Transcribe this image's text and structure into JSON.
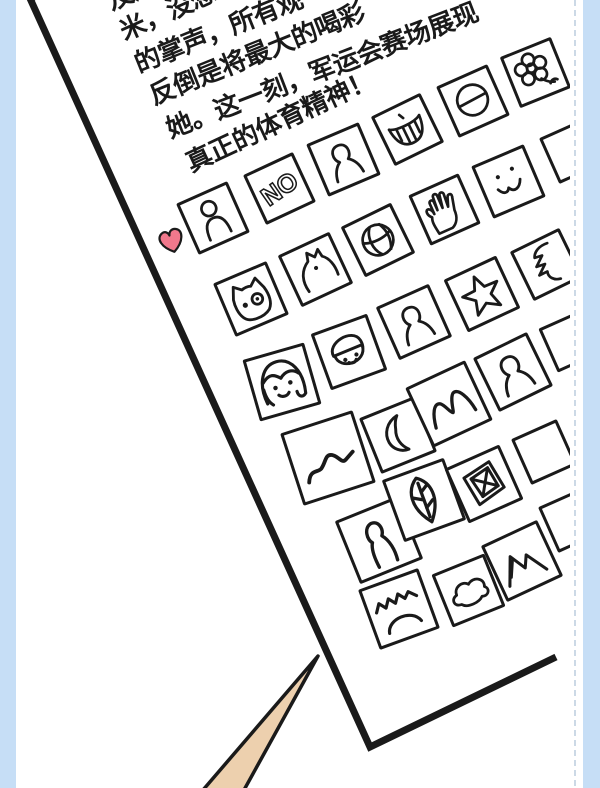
{
  "panel": {
    "type": "comic-webtoon-panel",
    "background_color": "#ffffff",
    "ink_color": "#1a1a1a"
  },
  "frame": {
    "side_strip_color": "#c6def6",
    "dashed_line_color": "#ccd9e6"
  },
  "page": {
    "description": "tilted white page with story text and a sheet of doodle stickers",
    "paragraph_lines": [
      "及远",
      "米，没想到",
      "的掌声，所有观",
      "反倒是将最大的喝彩",
      "她。这一刻，军运会赛场展现",
      "真正的体育精神！"
    ],
    "sticker_grid": {
      "no_label": "NO",
      "rows": [
        {
          "icons": [
            "person-outline",
            "no-text",
            "person-bust",
            "grin-teeth",
            "circle-slash",
            "flower"
          ]
        },
        {
          "icons": [
            "owl-face",
            "cat-profile",
            "basketball",
            "hand",
            "smiley-face",
            "clipped-box"
          ]
        },
        {
          "icons": [
            "girl-face",
            "boy-face",
            "person-bust",
            "star",
            "zigzag-profile"
          ]
        },
        {
          "icons": [
            "hills-line",
            "crescent-moon",
            "round-peaks",
            "person-bust",
            "clipped-box"
          ]
        },
        {
          "icons": [
            "person-tall",
            "leaf",
            "framed-note",
            "clipped-box"
          ]
        },
        {
          "icons": [
            "zigzag-waves-sun",
            "cloud",
            "mountains",
            "clipped-box"
          ]
        }
      ]
    },
    "heart_color": "#f1788c"
  },
  "pointer": {
    "description": "tan pointed tip touching the page corner",
    "fill_color": "#edd0ae"
  }
}
